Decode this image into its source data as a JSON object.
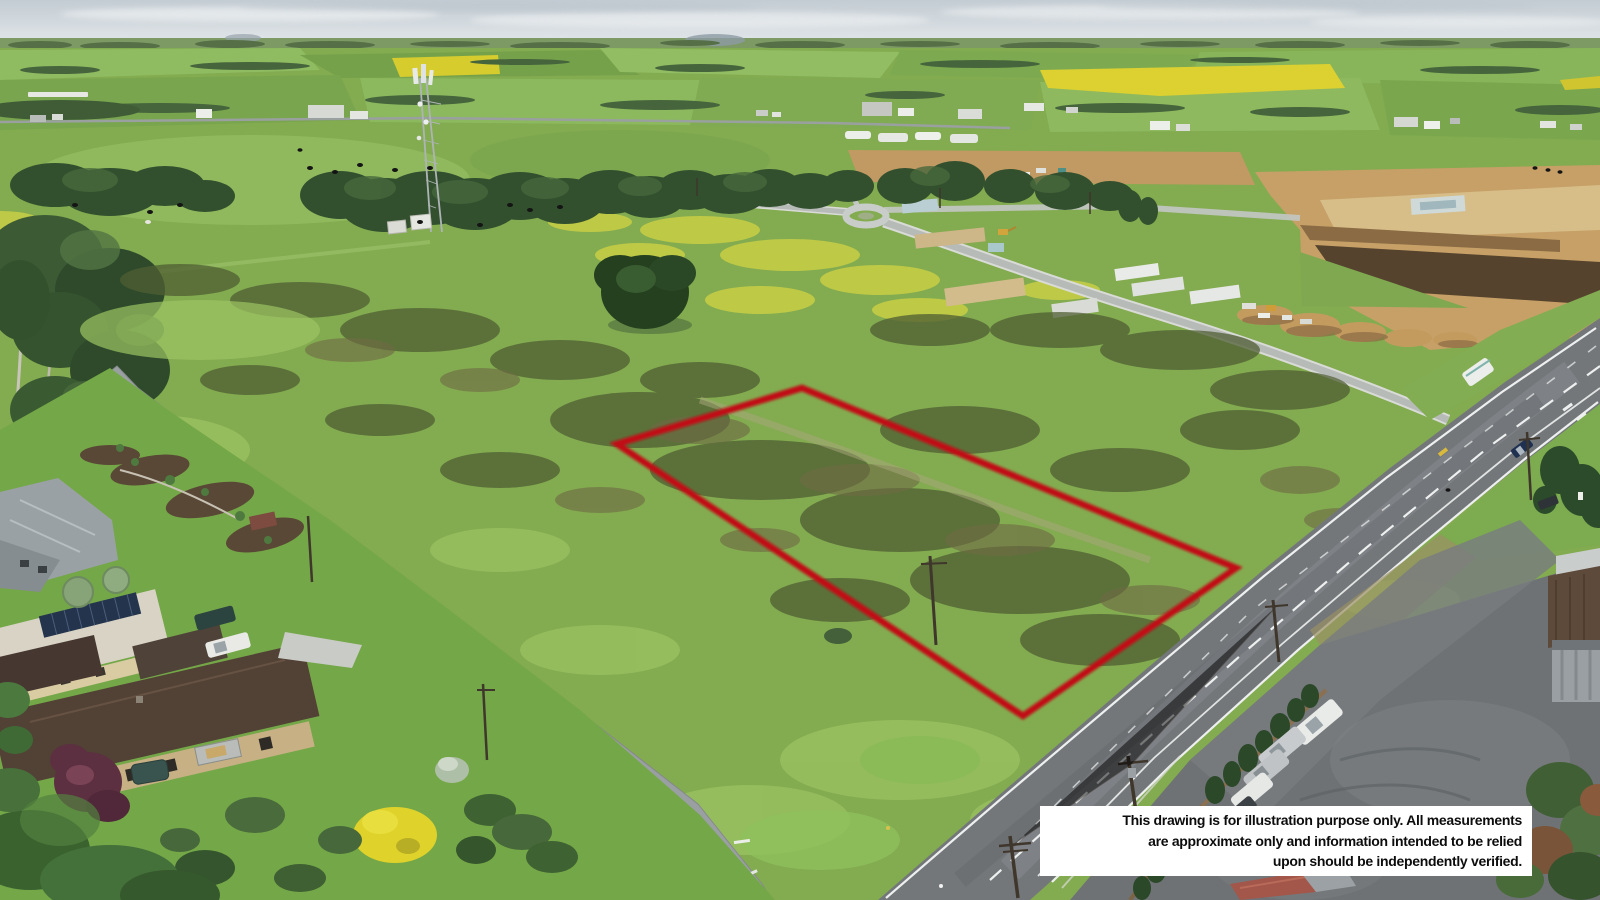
{
  "page": {
    "width_px": 1600,
    "height_px": 900
  },
  "photo": {
    "description": "Aerial drone photo of a grassy rural land parcel outlined in red beside a highway, with houses and gardens at lower left, a telecom tower and tree belt mid-left, a housing estate under construction with a roundabout and earthworks at upper right, a commercial yard with parked cars at lower right, and farmland with yellow canola fields to the horizon.",
    "boundary": {
      "color": "#c11113",
      "points_attr": "802,388 1236,568 1023,716 617,444"
    }
  },
  "disclaimer": {
    "background_color": "#ffffff",
    "text_color": "#0c0c0c",
    "lines": [
      "This drawing is for illustration purpose only. All measurements",
      "are approximate only and information intended to be relied",
      "upon should be independently verified."
    ]
  }
}
